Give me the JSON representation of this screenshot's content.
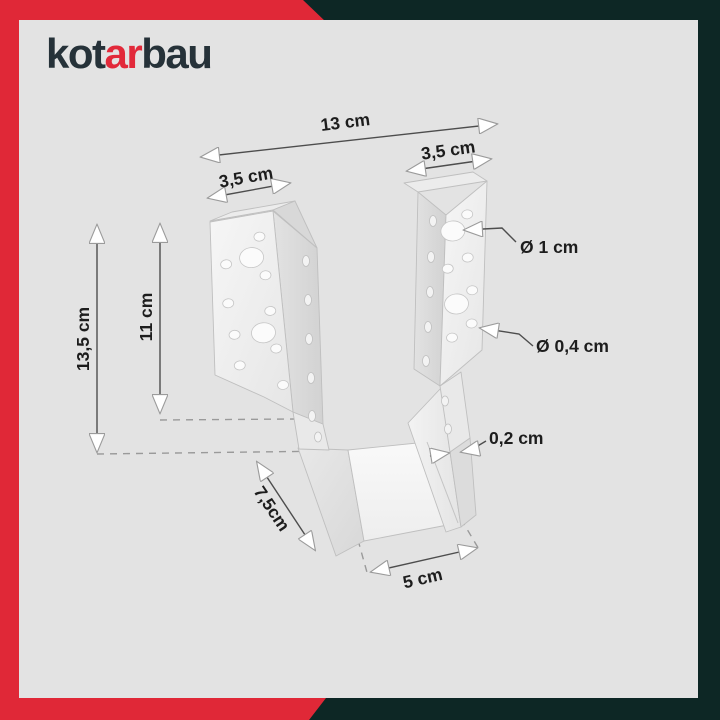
{
  "brand": {
    "name": "kotarbau",
    "logo_prefix": "kot",
    "logo_accent": "ar",
    "logo_suffix": "bau",
    "accent_color": "#e2293a",
    "dark_color": "#263239"
  },
  "frame": {
    "red": "#e02837",
    "dark_teal": "#0d2725",
    "panel_background": "#e3e3e3"
  },
  "diagram": {
    "type": "product-dimension-diagram",
    "dimensions": {
      "total_width": "13 cm",
      "flange_width_left": "3,5 cm",
      "flange_width_right": "3,5 cm",
      "overall_height": "13,5 cm",
      "side_height": "11 cm",
      "large_hole_diameter": "Ø 1 cm",
      "small_hole_diameter": "Ø 0,4 cm",
      "material_thickness": "0,2 cm",
      "depth": "7,5cm",
      "inner_width": "5 cm"
    }
  }
}
